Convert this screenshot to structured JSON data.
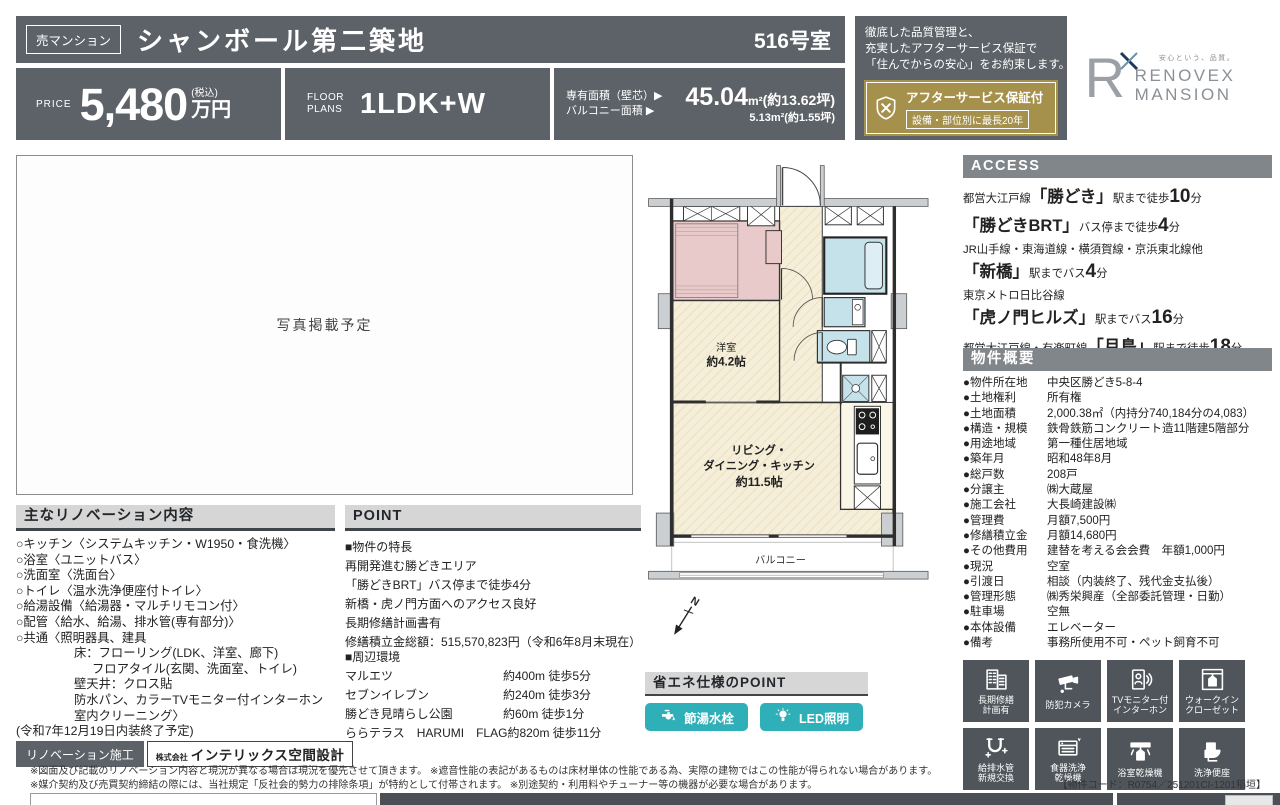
{
  "colors": {
    "slate": "#5c6267",
    "bargray": "#81868b",
    "headgray": "#d6d6d6",
    "gold": "#a5914c",
    "teal": "#2fb0b8",
    "tile": "#4f555b",
    "cream": "#f5eed8",
    "pink": "#e9caca",
    "blue": "#c5e1ea"
  },
  "header": {
    "type_badge": "売マンション",
    "title": "シャンボール第二築地",
    "room": "516号室",
    "price_label": "PRICE",
    "price_value": "5,480",
    "price_tax": "(税込)",
    "price_unit": "万円",
    "plans_label1": "FLOOR",
    "plans_label2": "PLANS",
    "plans_value": "1LDK+W",
    "area1_label": "専有面積（壁芯）▶",
    "area1_main": "45.04",
    "area1_unit": "m²",
    "area1_tsubo": "(約13.62坪)",
    "area2_label": "バルコニー面積 ▶",
    "area2_value": "5.13m²(約1.55坪)"
  },
  "assurance": {
    "line1": "徹底した品質管理と、",
    "line2": "充実したアフターサービス保証で",
    "line3": "「住んでからの安心」をお約束します。",
    "badge_title": "アフターサービス保証付",
    "badge_sub": "設備・部位別に最長20年"
  },
  "brand": {
    "mark": "R",
    "tagline": "安心という、品質。",
    "name1": "RENOVEX",
    "name2": "MANSION"
  },
  "photo": {
    "placeholder": "写真掲載予定"
  },
  "renovation": {
    "heading": "主なリノベーション内容",
    "items": [
      [
        "○キッチン〈システムキッチン・W1950・食洗機〉",
        0
      ],
      [
        "○浴室〈ユニットバス〉",
        0
      ],
      [
        "○洗面室〈洗面台〉",
        0
      ],
      [
        "○トイレ〈温水洗浄便座付トイレ〉",
        0
      ],
      [
        "○給湯設備〈給湯器・マルチリモコン付〉",
        0
      ],
      [
        "○配管〈給水、給湯、排水管(専有部分)〉",
        0
      ],
      [
        "○共通〈照明器具、建具",
        0
      ],
      [
        "床：フローリング(LDK、洋室、廊下)",
        1
      ],
      [
        "フロアタイル(玄関、洗面室、トイレ)",
        2
      ],
      [
        "壁天井：クロス貼",
        1
      ],
      [
        "防水パン、カラーTVモニター付インターホン",
        1
      ],
      [
        "室内クリーニング〉",
        1
      ],
      [
        "(令和7年12月19日内装終了予定)",
        0
      ]
    ],
    "construction_label": "リノベーション施工",
    "company_prefix": "株式会社",
    "company_name": "インテリックス空間設計"
  },
  "point": {
    "heading": "POINT",
    "features_heading": "■物件の特長",
    "features": [
      "再開発進む勝どきエリア",
      "「勝どきBRT」バス停まで徒歩4分",
      "新橋・虎ノ門方面へのアクセス良好",
      "長期修繕計画書有",
      "修繕積立金総額：515,570,823円（令和6年8月末現在）"
    ],
    "surroundings_heading": "■周辺環境",
    "surroundings": [
      {
        "name": "マルエツ",
        "distance": "約400m 徒歩5分"
      },
      {
        "name": "セブンイレブン",
        "distance": "約240m 徒歩3分"
      },
      {
        "name": "勝どき見晴らし公園",
        "distance": "約60m 徒歩1分"
      },
      {
        "name": "ららテラス　HARUMI　FLAG",
        "distance": "約820m 徒歩11分"
      }
    ]
  },
  "eco": {
    "heading": "省エネ仕様のPOINT",
    "buttons": [
      {
        "icon": "faucet-icon",
        "label": "節湯水栓"
      },
      {
        "icon": "bulb-icon",
        "label": "LED照明"
      }
    ]
  },
  "floorplan": {
    "west_room_l1": "洋室",
    "west_room_l2": "約4.2帖",
    "ldk_l1": "リビング・",
    "ldk_l2": "ダイニング・キッチン",
    "ldk_l3": "約11.5帖",
    "balcony": "バルコニー",
    "north": "N"
  },
  "access": {
    "heading": "ACCESS",
    "routes": [
      [
        [
          [
            "都営大江戸線",
            "s"
          ],
          [
            "「勝どき」",
            "b"
          ],
          [
            "駅まで徒歩",
            "s"
          ],
          [
            "10",
            "n"
          ],
          [
            "分",
            "s"
          ]
        ]
      ],
      [
        [
          [
            "「勝どきBRT」",
            "b"
          ],
          [
            "バス停まで徒歩",
            "s"
          ],
          [
            "4",
            "n"
          ],
          [
            "分",
            "s"
          ]
        ]
      ],
      [
        [
          [
            "JR山手線・東海道線・横須賀線・京浜東北線他",
            "s"
          ]
        ],
        [
          [
            "「新橋」",
            "b"
          ],
          [
            "駅までバス",
            "s"
          ],
          [
            "4",
            "n"
          ],
          [
            "分",
            "s"
          ]
        ]
      ],
      [
        [
          [
            "東京メトロ日比谷線",
            "s"
          ]
        ],
        [
          [
            "「虎ノ門ヒルズ」",
            "b"
          ],
          [
            "駅までバス",
            "s"
          ],
          [
            "16",
            "n"
          ],
          [
            "分",
            "s"
          ]
        ]
      ],
      [
        [
          [
            "都営大江戸線・有楽町線",
            "s"
          ],
          [
            "「月島」",
            "b"
          ],
          [
            "駅まで徒歩",
            "s"
          ],
          [
            "18",
            "n"
          ],
          [
            "分",
            "s"
          ]
        ]
      ]
    ]
  },
  "overview": {
    "heading": "物件概要",
    "bullet": "●",
    "rows": [
      {
        "label": "物件所在地",
        "value": "中央区勝どき5-8-4"
      },
      {
        "label": "土地権利",
        "value": "所有権"
      },
      {
        "label": "土地面積",
        "value": "2,000.38㎡（内持分740,184分の4,083）"
      },
      {
        "label": "構造・規模",
        "value": "鉄骨鉄筋コンクリート造11階建5階部分"
      },
      {
        "label": "用途地域",
        "value": "第一種住居地域"
      },
      {
        "label": "築年月",
        "value": "昭和48年8月"
      },
      {
        "label": "総戸数",
        "value": "208戸"
      },
      {
        "label": "分譲主",
        "value": "㈱大蔵屋"
      },
      {
        "label": "施工会社",
        "value": "大長崎建設㈱"
      },
      {
        "label": "管理費",
        "value": "月額7,500円"
      },
      {
        "label": "修繕積立金",
        "value": "月額14,680円"
      },
      {
        "label": "その他費用",
        "value": "建替を考える会会費　年額1,000円"
      },
      {
        "label": "現況",
        "value": "空室"
      },
      {
        "label": "引渡日",
        "value": "相談（内装終了、残代金支払後）"
      },
      {
        "label": "管理形態",
        "value": "㈱秀栄興産（全部委託管理・日勤）"
      },
      {
        "label": "駐車場",
        "value": "空無"
      },
      {
        "label": "本体設備",
        "value": "エレベーター"
      },
      {
        "label": "備考",
        "value": "事務所使用不可・ペット飼育不可"
      }
    ]
  },
  "feature_icons": [
    {
      "icon": "building-repair-icon",
      "lines": [
        "長期修繕",
        "計画有"
      ]
    },
    {
      "icon": "security-camera-icon",
      "lines": [
        "防犯カメラ"
      ]
    },
    {
      "icon": "tv-intercom-icon",
      "lines": [
        "TVモニター付",
        "インターホン"
      ]
    },
    {
      "icon": "walkin-closet-icon",
      "lines": [
        "ウォークイン",
        "クローゼット"
      ]
    },
    {
      "icon": "pipe-replacement-icon",
      "lines": [
        "給排水管",
        "新規交換"
      ]
    },
    {
      "icon": "dishwasher-icon",
      "lines": [
        "食器洗浄",
        "乾燥機"
      ]
    },
    {
      "icon": "bath-dryer-icon",
      "lines": [
        "浴室乾燥機"
      ]
    },
    {
      "icon": "washlet-icon",
      "lines": [
        "洗浄便座"
      ]
    }
  ],
  "footer": {
    "note1": "※図面及び記載のリノベーション内容と現況が異なる場合は現況を優先させて頂きます。 ※遮音性能の表記があるものは床材単体の性能である為、実際の建物ではこの性能が得られない場合があります。",
    "note2": "※媒介契約及び売買契約締結の際には、当社規定「反社会的勢力の排除条項」が特約として付帯されます。 ※別途契約・利用料やチューナー等の機器が必要な場合があります。",
    "code": "【物件コード：R0754／251201CI-1201稲垣】"
  }
}
